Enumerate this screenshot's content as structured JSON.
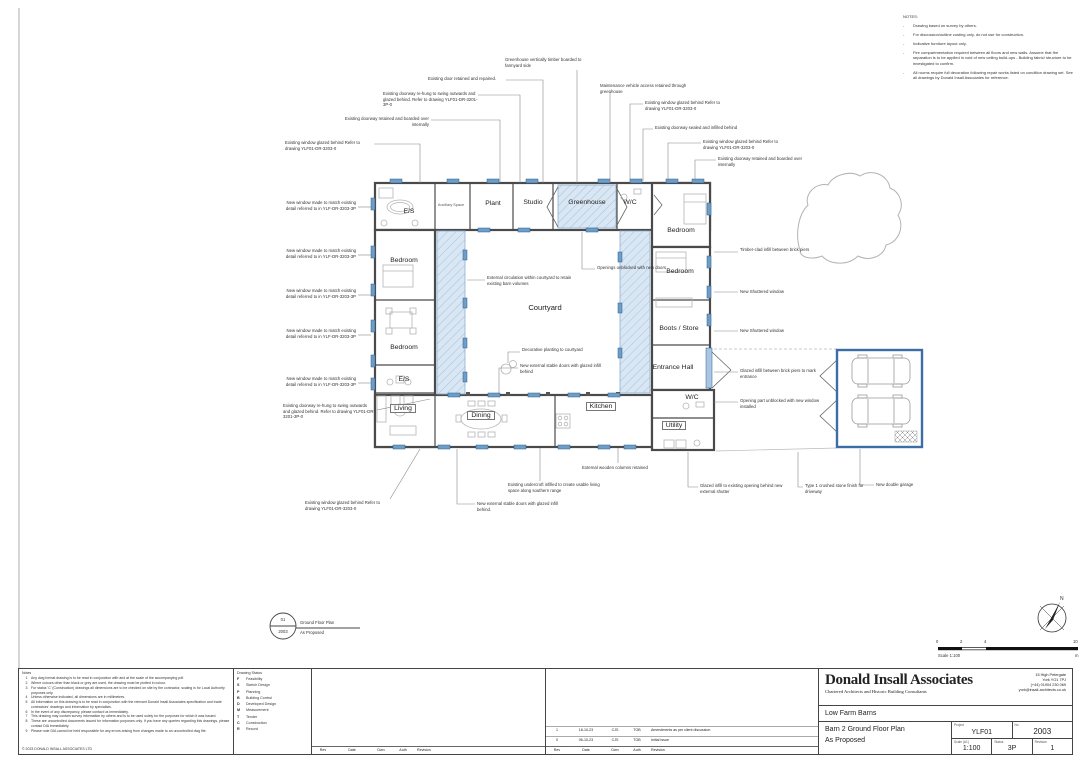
{
  "notes_panel": {
    "title": "NOTES:",
    "items": [
      "Drawing based on survey by others.",
      "For discussion/outline costing only, do not use for construction.",
      "Indicative furniture layout only.",
      "Fire compartmentation required between all floors and new walls. Assume that fire separation is to be applied in void of new ceiling build-ups - Building fabric/ structure to be investigated to confirm.",
      "All rooms require full decoration following repair works listed on condition drawing set. See all drawings by Donald Insall Associates for reference."
    ]
  },
  "rooms": {
    "es_north": "E/S",
    "ancillary": "Ancillary Space",
    "plant": "Plant",
    "studio": "Studio",
    "greenhouse": "Greenhouse",
    "wc_north": "W/C",
    "bedroom_ne": "Bedroom",
    "bedroom_w1": "Bedroom",
    "bedroom_e": "Bedroom",
    "courtyard": "Courtyard",
    "boots_store": "Boots / Store",
    "bedroom_w2": "Bedroom",
    "es_west": "E/S",
    "entrance_hall": "Entrance Hall",
    "living": "Living",
    "dining": "Dining",
    "kitchen": "Kitchen",
    "wc_east": "W/C",
    "utility": "Utility"
  },
  "annotations": {
    "greenhouse_timber": "Greenhouse vertically timber boarded to farmyard side",
    "door_retained_repaired": "Existing door retained and repaired.",
    "doorway_rehung_top": "Existing doorway re-hung to swing outwards and glazed behind. Refer to drawing YLF01-DR-3201-3P-0",
    "doorway_boarded_top": "Existing doorway retained and boarded over internally",
    "window_glazed_left_top": "Existing window glazed behind Refer to drawing YLF01-DR-3203-0",
    "maintenance_access": "Maintenance vehicle access retained through greenhouse",
    "window_glazed_r1": "Existing window glazed behind Refer to drawing YLF01-DR-3203-0",
    "doorway_sealed": "Existing doorway sealed and infilled behind",
    "window_glazed_r2": "Existing window glazed behind Refer to drawing YLF01-DR-3203-0",
    "doorway_boarded_right": "Existing doorway retained and boarded over internally",
    "new_window_match": "New window made to match existing detail referred to in YLF-DR-3203-3P",
    "timber_clad_infill": "Timber-clad infill between brick piers",
    "new_shuttered_1": "New Shuttered window",
    "new_shuttered_2": "New Shuttered window",
    "external_circulation": "External circulation within courtyard to retain existing barn volumes",
    "openings_unblocked": "Openings unblocked with new doors",
    "decorative_planting": "Decorative planting to courtyard",
    "stable_doors_court": "New external stable doors with glazed infill behind",
    "glazed_infill_entrance": "Glazed infill between brick piers to mark entrance",
    "opening_unblocked_window": "Opening part unblocked with new window installed",
    "doorway_rehung_bottom": "Existing doorway re-hung to swing outwards and glazed behind. Refer to drawing YLF01-DR-3201-3P-0",
    "window_glazed_bottom": "Existing window glazed behind Refer to drawing YLF01-DR-3203-0",
    "wooden_columns": "External wooden columns retained",
    "undercroft": "Existing undercroft infilled to create usable living space along southern range",
    "stable_doors_bottom": "New external stable doors with glazed infill behind.",
    "glazed_infill_shutter": "Glazed infill to existing opening behind new external shutter",
    "crushed_stone": "Type 1 crushed stone finish for driveway",
    "double_garage": "New double garage"
  },
  "key_ref": {
    "number": "01",
    "sheet": "2003",
    "line1": "Ground Floor Plan",
    "line2": "As Proposed"
  },
  "scale_bar": {
    "t0": "0",
    "t1": "2",
    "t2": "4",
    "t3": "10",
    "label": "Scale 1:100",
    "unit": "m"
  },
  "north_label": "N",
  "colors": {
    "new_work_blue": "#4a7ab5",
    "hatch_blue": "#d6e4f2",
    "wall_grey": "#4a4a4a"
  },
  "footer": {
    "notes_title": "Notes",
    "notes": [
      "Any dwg format drawing is to be read in conjunction with and at the scale of the accompanying pdf.",
      "Where colours other than black or grey are used, the drawing must be plotted in colour.",
      "For status 'C' (Construction) drawings all dimensions are to be checked on site by the contractor, scaling is for Local Authority purposes only.",
      "Unless otherwise indicated, all dimensions are in millimetres.",
      "All information on this drawing is to be read in conjunction with the relevant Donald Insall Associates specification and trade contractors' drawings and information by specialists.",
      "In the event of any discrepancy, please contact us immediately.",
      "This drawing may contain survey information by others and is to be used solely for the purposes for which it was issued.",
      "These are uncontrolled documents issued for information purposes only. If you have any queries regarding this drawings, please contact DIA immediately.",
      "Please note DIA cannot be held responsible for any errors arising from changes made to an uncontrolled dwg file."
    ],
    "copyright": "© 2023 DONALD INSALL ASSOCIATES LTD",
    "drawing_status": {
      "title": "Drawing Status",
      "items": [
        {
          "code": "F",
          "label": "Feasibility"
        },
        {
          "code": "S",
          "label": "Sketch Design"
        },
        {
          "code": "P",
          "label": "Planning"
        },
        {
          "code": "B",
          "label": "Building Control"
        },
        {
          "code": "D",
          "label": "Developed Design"
        },
        {
          "code": "M",
          "label": "Measurement"
        },
        {
          "code": "T",
          "label": "Tender"
        },
        {
          "code": "C",
          "label": "Construction"
        },
        {
          "code": "R",
          "label": "Record"
        }
      ]
    },
    "rev_table": {
      "columns": [
        "Rev",
        "Date",
        "Dwn",
        "Auth",
        "Revision"
      ],
      "rows": [
        [
          "1",
          "18-10-23",
          "CJS",
          "TOB",
          "Amendments as per client discussion"
        ],
        [
          "0",
          "06-10-23",
          "CJS",
          "TOB",
          "Initial Issue"
        ]
      ]
    },
    "title_block": {
      "firm": "Donald Insall Associates",
      "tagline": "Chartered Architects and Historic Building Consultants",
      "addr1": "15 High Petergate",
      "addr2": "York YO1 7PJ",
      "addr3": "(+44) 01904 230 069",
      "addr4": "york@insall-architects.co.uk",
      "project_title": "Low Farm Barns",
      "drawing_title_1": "Barn 2 Ground Floor Plan",
      "drawing_title_2": "As Proposed",
      "project_label": "Project",
      "project": "YLF01",
      "no_label": "No",
      "no": "2003",
      "scale_label": "Scale (A1)",
      "scale": "1:100",
      "status_label": "Status",
      "status": "3P",
      "revision_label": "Revision",
      "revision": "1"
    }
  }
}
